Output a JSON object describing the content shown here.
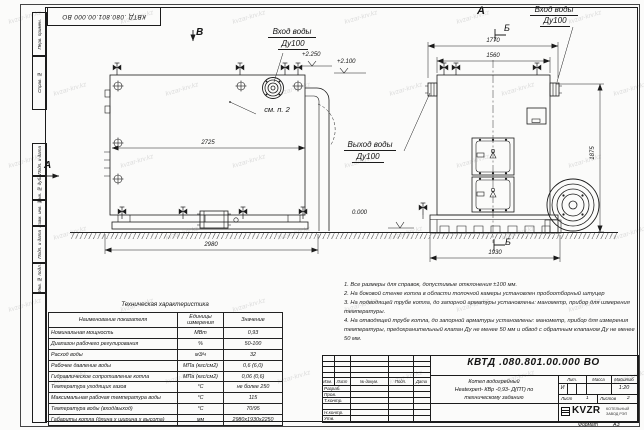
{
  "watermark": {
    "text": "kvzar-krv.kz"
  },
  "stamp": {
    "doc_number_rotated": "КВТД .080.801.00.000  ВО"
  },
  "margin_fields": {
    "f0": "Перв. примен.",
    "f1": "Справ. №",
    "f2": "Подп. и дата",
    "f3": "Инв. № дубл.",
    "f4": "Взам. инв. №",
    "f5": "Подп. и дата",
    "f6": "Инв. № подл."
  },
  "side_view": {
    "view_label": "В",
    "arrow_label": "А",
    "inlet_line1": "Вход воды",
    "inlet_line2": "Ду100",
    "see_note": "см. п. 2",
    "elev_top": "+2.250",
    "elev_mid": "+2.100",
    "dim_inner": "2725",
    "dim_total": "2980"
  },
  "front_view": {
    "view_label": "А",
    "section_top": "Б",
    "section_bottom": "Б",
    "inlet_line1": "Вход воды",
    "inlet_line2": "Ду100",
    "outlet_line1": "Выход воды",
    "outlet_line2": "Ду100",
    "elev_zero": "0.000",
    "dim_outer": "1770",
    "dim_inner": "1560",
    "dim_height": "1875",
    "dim_bottom": "1930"
  },
  "notes": [
    "1. Все размеры для справок, допустимые отклонения ±100 мм.",
    "2. На боковой стенке котла в области топочной камеры установлен пробоотборный штуцер",
    "3. На подводящей трубе котла, до запорной арматуры установлены: манометр, прибор для измерения температуры.",
    "4. На отводящей трубе котла, до запорной арматуры установлены: манометр, прибор для измерения температуры, предохранительный клапан Ду не менее 50 мм и обвод с обратным клапаном Ду не менее 50 мм."
  ],
  "tech_table": {
    "title": "Техническая характеристика",
    "headers": [
      "Наименование показателя",
      "Единицы измерения",
      "Значение"
    ],
    "rows": [
      {
        "name": "Номинальная мощность",
        "unit": "МВт",
        "value": "0,93"
      },
      {
        "name": "Диапазон рабочего регулирования",
        "unit": "%",
        "value": "50-100"
      },
      {
        "name": "Расход воды",
        "unit": "м3/ч",
        "value": "32"
      },
      {
        "name": "Рабочее давление воды",
        "unit": "МПа (кгс/см2)",
        "value": "0,6 (6,0)"
      },
      {
        "name": "Гидравлическое сопротивление котла",
        "unit": "МПа (кгс/см2)",
        "value": "0,06 (0,6)"
      },
      {
        "name": "Температура уходящих газов",
        "unit": "°С",
        "value": "не более 250"
      },
      {
        "name": "Максимальная рабочая температура воды",
        "unit": "°С",
        "value": "115"
      },
      {
        "name": "Температура воды (вход/выход)",
        "unit": "°С",
        "value": "70/95"
      },
      {
        "name": "Габариты котла (длина х ширина х высота)",
        "unit": "мм",
        "value": "2980х1930х2250"
      }
    ]
  },
  "title_block": {
    "doc_number": "КВТД .080.801.00.000  ВО",
    "name_line1": "Котел водогрейный",
    "name_line2": "Heatexpert- КВр -0,93- Д(ПТ) по",
    "name_line3": "техническому заданию",
    "col_izm": "Изм.",
    "col_list": "Лист",
    "col_doc": "№ докум.",
    "col_sign": "Подп.",
    "col_date": "Дата",
    "row_developed": "Разраб.",
    "row_checked": "Пров.",
    "row_tcontrol": "Т.контр.",
    "row_ncontrol": "Н.контр.",
    "row_approved": "Утв.",
    "lit_label": "Лит.",
    "lit_value": "И",
    "mass_label": "Масса",
    "scale_label": "Масштаб",
    "scale_value": "1:20",
    "sheet_label": "Лист",
    "sheet_value": "1",
    "sheets_label": "Листов",
    "sheets_value": "2",
    "logo": "KVZR",
    "company_line1": "КОТЕЛЬНЫЙ",
    "company_line2": "ЗАВОД РЭП",
    "format_label": "Формат",
    "format_value": "А3"
  }
}
